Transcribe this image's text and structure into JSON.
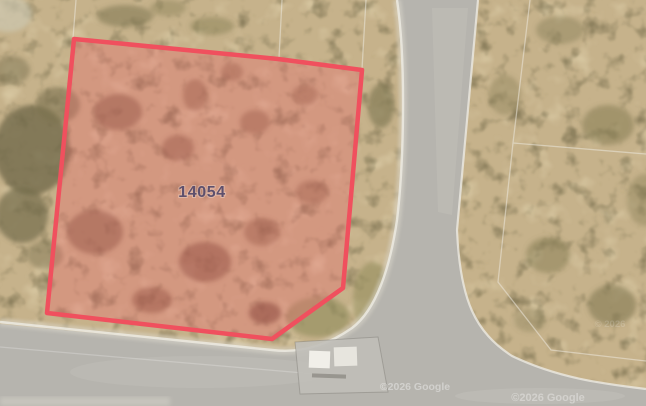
{
  "map": {
    "parcel_label": "14054",
    "watermarks": {
      "tile_1": "©2026 Google",
      "tile_2": "©2026 Google",
      "tile_3": "© 2026"
    },
    "colors": {
      "parcel_stroke": "#f0505e",
      "parcel_fill": "rgba(236,104,108,0.34)",
      "parcel_label": "#5e506d",
      "terrain_base": "#c6b28b",
      "road": "#b6b4ae",
      "curb": "#eceae2",
      "boundary_line": "#ece8dc"
    }
  }
}
